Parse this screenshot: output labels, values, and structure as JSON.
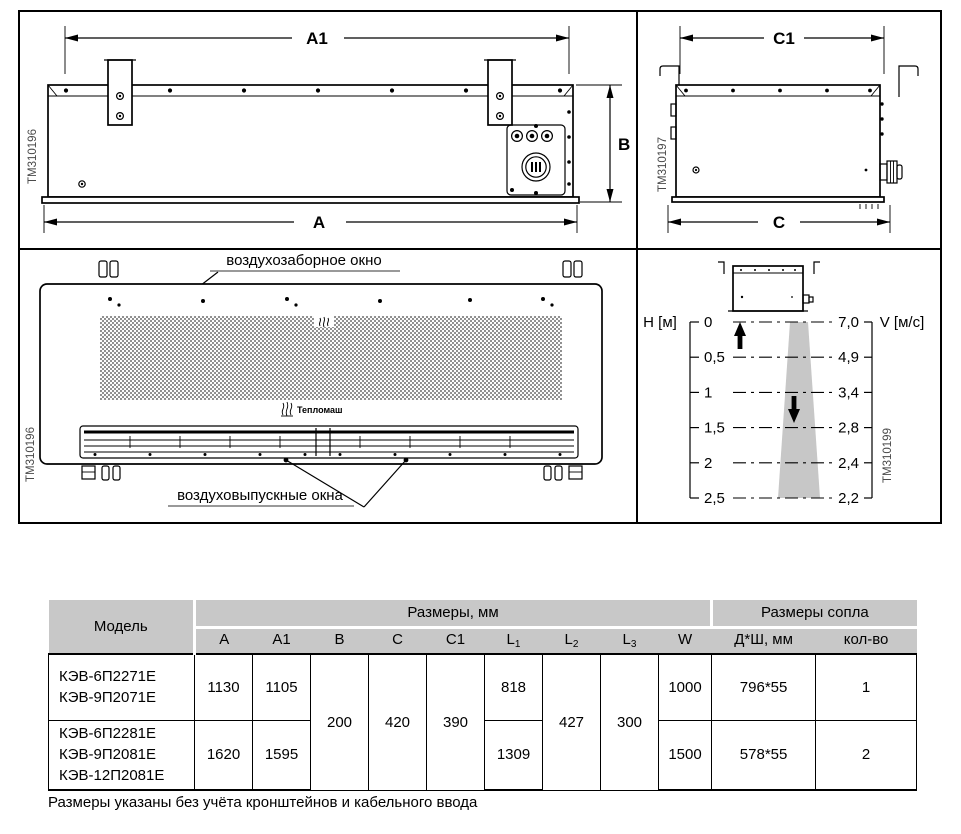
{
  "figure": {
    "rear": {
      "dim_a1": "A1",
      "dim_a": "A",
      "dim_b": "B",
      "id": "TM310196"
    },
    "side": {
      "dim_c1": "C1",
      "dim_c": "C",
      "id": "TM310197"
    },
    "front": {
      "intake_label": "воздухозаборное окно",
      "outlet_label": "воздуховыпускные окна",
      "brand": "Тепломаш",
      "id": "TM310196"
    },
    "flow": {
      "id": "TM310199",
      "h_label": "H [м]",
      "v_label": "V [м/с]",
      "h_ticks": [
        "0",
        "0,5",
        "1",
        "1,5",
        "2",
        "2,5"
      ],
      "v_ticks": [
        "7,0",
        "4,9",
        "3,4",
        "2,8",
        "2,4",
        "2,2"
      ]
    }
  },
  "chart_data": {
    "type": "line",
    "xlabel": "H [м]",
    "ylabel": "V [м/с]",
    "x": [
      0,
      0.5,
      1,
      1.5,
      2,
      2.5
    ],
    "series": [
      {
        "name": "V",
        "values": [
          7.0,
          4.9,
          3.4,
          2.8,
          2.4,
          2.2
        ]
      }
    ],
    "grid": "dash-dot horizontal levels",
    "legend": "none"
  },
  "table": {
    "header": {
      "model": "Модель",
      "dims_group": "Размеры, мм",
      "nozzle_group": "Размеры сопла",
      "cols": [
        {
          "t": "A",
          "s": ""
        },
        {
          "t": "A1",
          "s": ""
        },
        {
          "t": "B",
          "s": ""
        },
        {
          "t": "C",
          "s": ""
        },
        {
          "t": "C1",
          "s": ""
        },
        {
          "t": "L",
          "s": "1"
        },
        {
          "t": "L",
          "s": "2"
        },
        {
          "t": "L",
          "s": "3"
        },
        {
          "t": "W",
          "s": ""
        },
        {
          "t": "Д*Ш, мм",
          "s": ""
        },
        {
          "t": "кол-во",
          "s": ""
        }
      ]
    },
    "merged": {
      "b": "200",
      "c": "420",
      "c1": "390",
      "l2": "427",
      "l3": "300"
    },
    "rows": [
      {
        "models": [
          "КЭВ-6П2271Е",
          "КЭВ-9П2071Е"
        ],
        "a": "1130",
        "a1": "1105",
        "l1": "818",
        "w": "1000",
        "nozzle": "796*55",
        "count": "1"
      },
      {
        "models": [
          "КЭВ-6П2281Е",
          "КЭВ-9П2081Е",
          "КЭВ-12П2081Е"
        ],
        "a": "1620",
        "a1": "1595",
        "l1": "1309",
        "w": "1500",
        "nozzle": "578*55",
        "count": "2"
      }
    ]
  },
  "footnote": "Размеры указаны без учёта кронштейнов и кабельного ввода"
}
